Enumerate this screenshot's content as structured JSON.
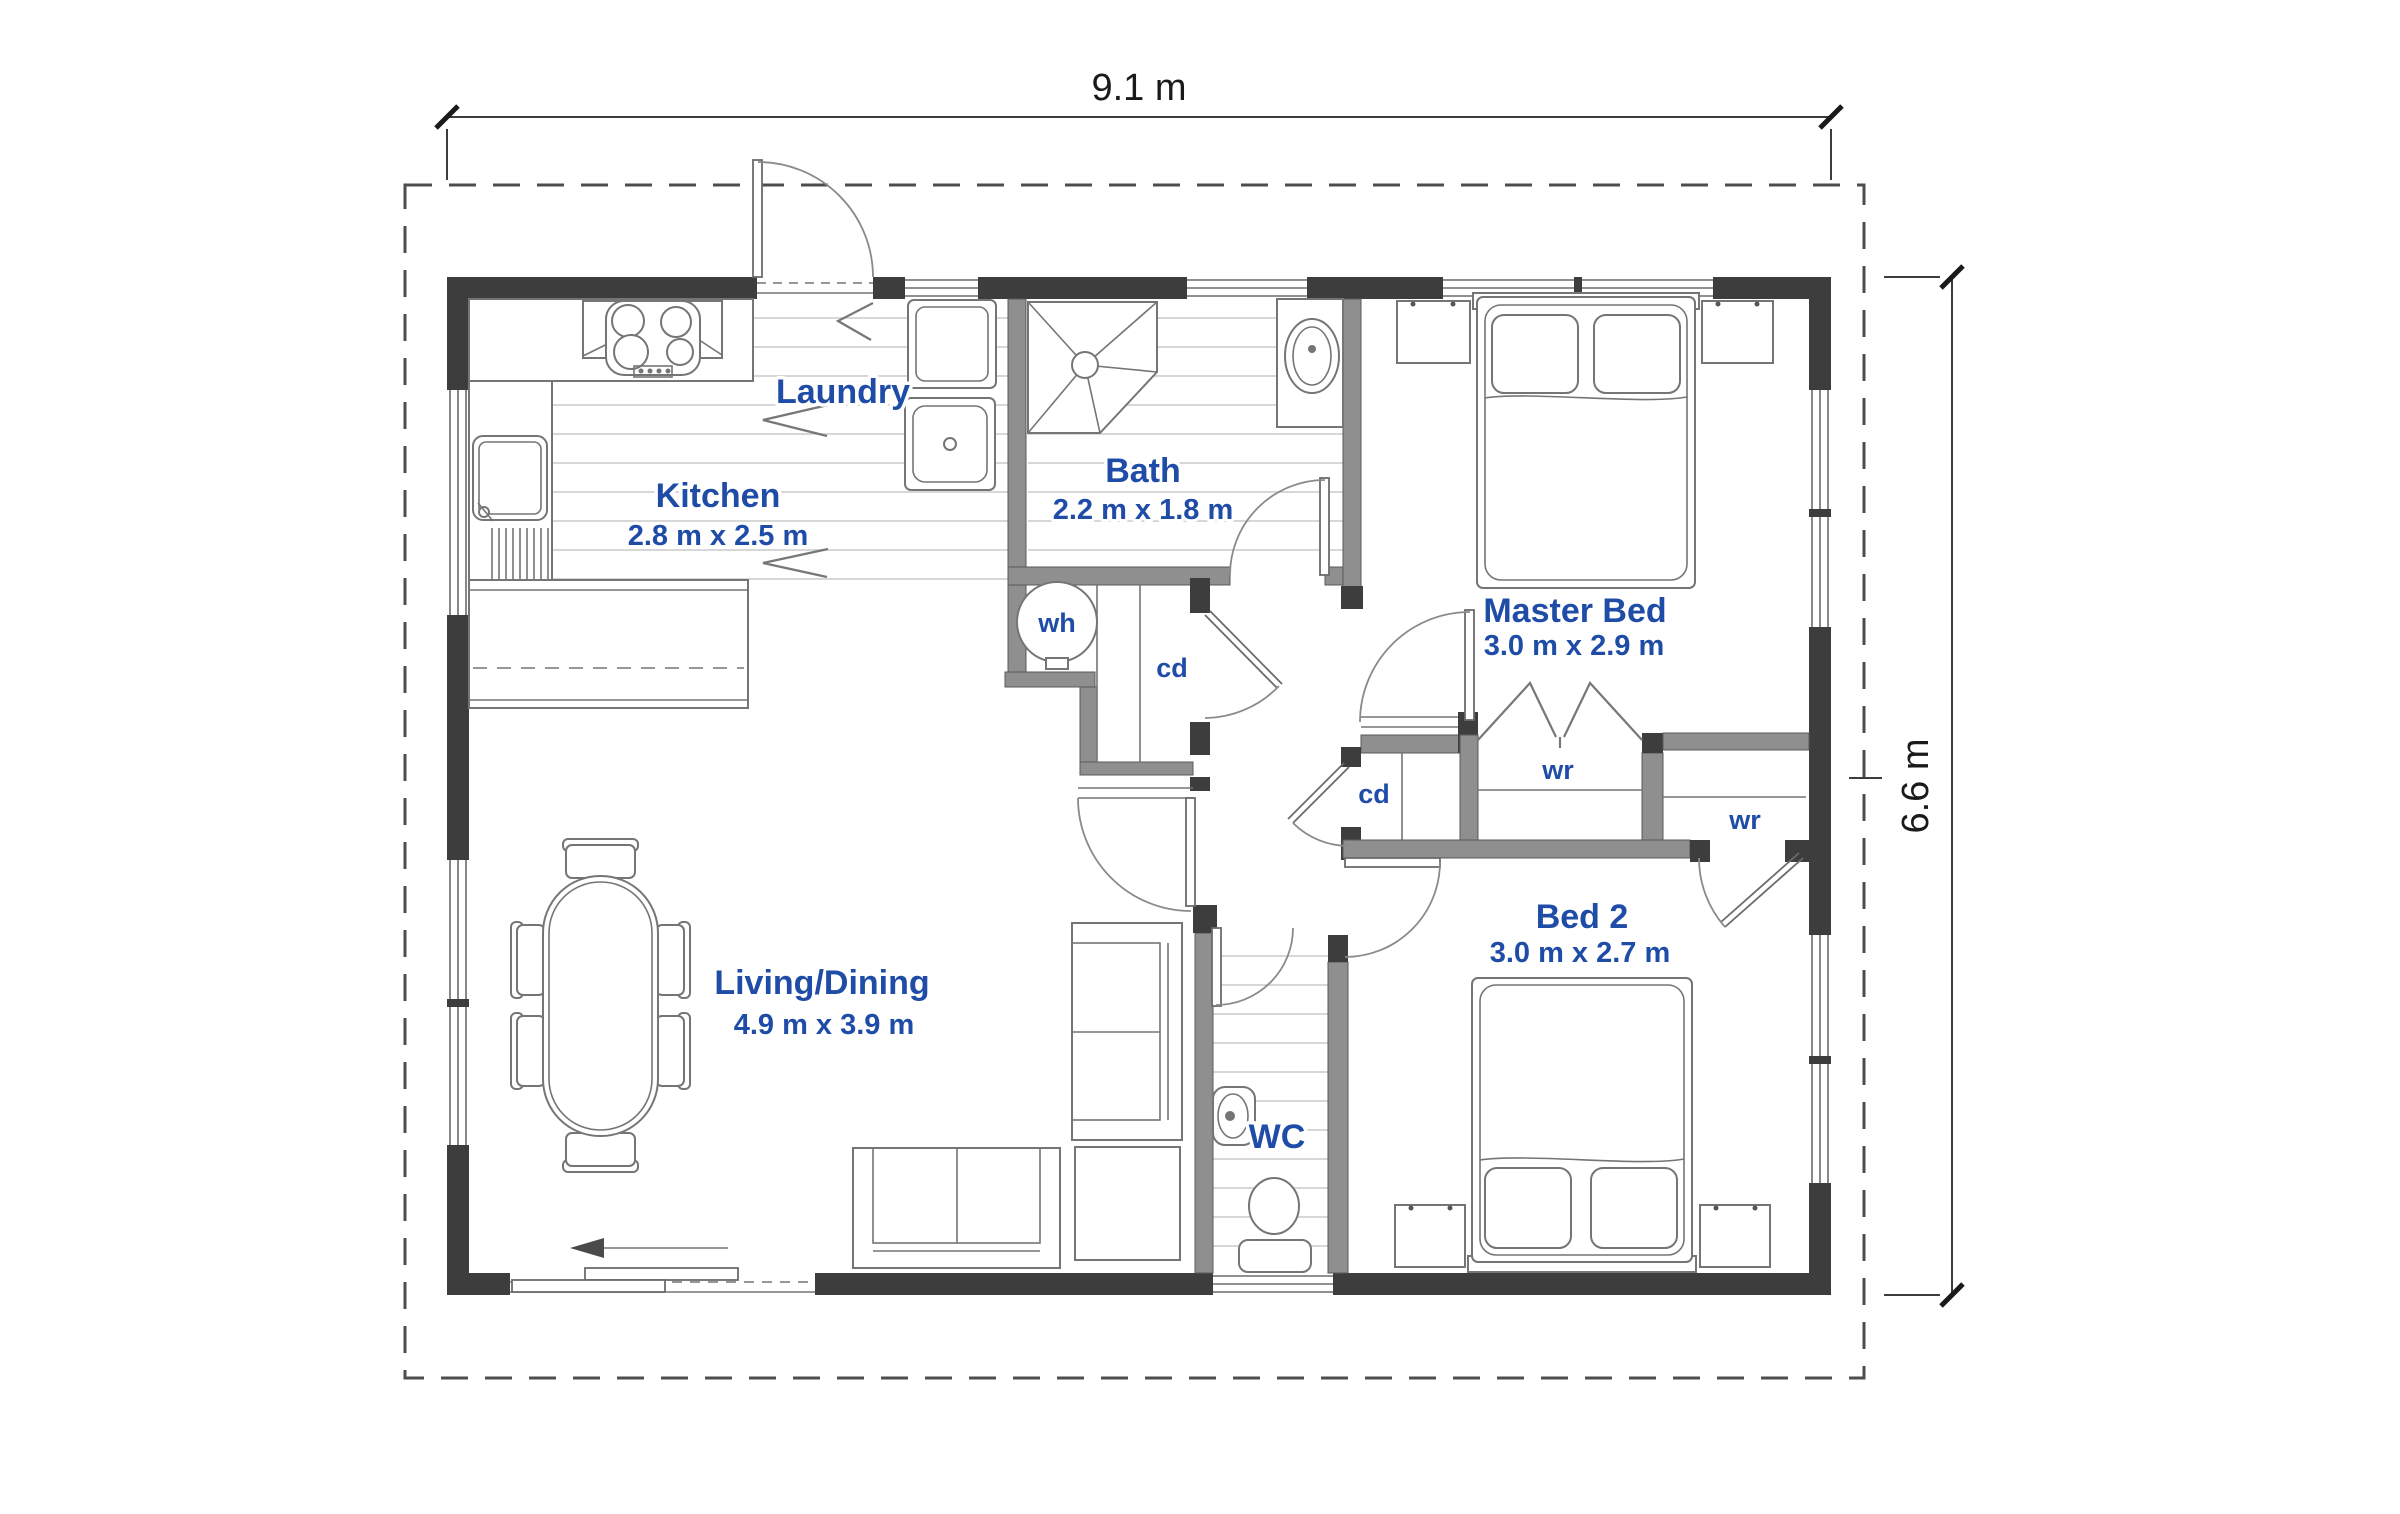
{
  "colors": {
    "blue": "#1f4ca6",
    "wall-dark": "#3d3d3d",
    "wall-gray": "#8f8f8f",
    "boundary": "#4d4d4d",
    "furn-line": "#757575"
  },
  "dimensions": {
    "width_label": "9.1 m",
    "height_label": "6.6 m"
  },
  "rooms": {
    "laundry": {
      "name": "Laundry"
    },
    "kitchen": {
      "name": "Kitchen",
      "size": "2.8 m x 2.5 m"
    },
    "bath": {
      "name": "Bath",
      "size": "2.2 m x 1.8 m"
    },
    "master_bed": {
      "name": "Master Bed",
      "size": "3.0 m x 2.9 m"
    },
    "bed2": {
      "name": "Bed 2",
      "size": "3.0 m x 2.7 m"
    },
    "living_dining": {
      "name": "Living/Dining",
      "size": "4.9 m x 3.9 m"
    },
    "wc": {
      "name": "WC"
    }
  },
  "fixtures": {
    "water_heater": "wh",
    "cupboard_hall": "cd",
    "cupboard_bed": "cd",
    "wardrobe_master": "wr",
    "wardrobe_bed2": "wr"
  }
}
